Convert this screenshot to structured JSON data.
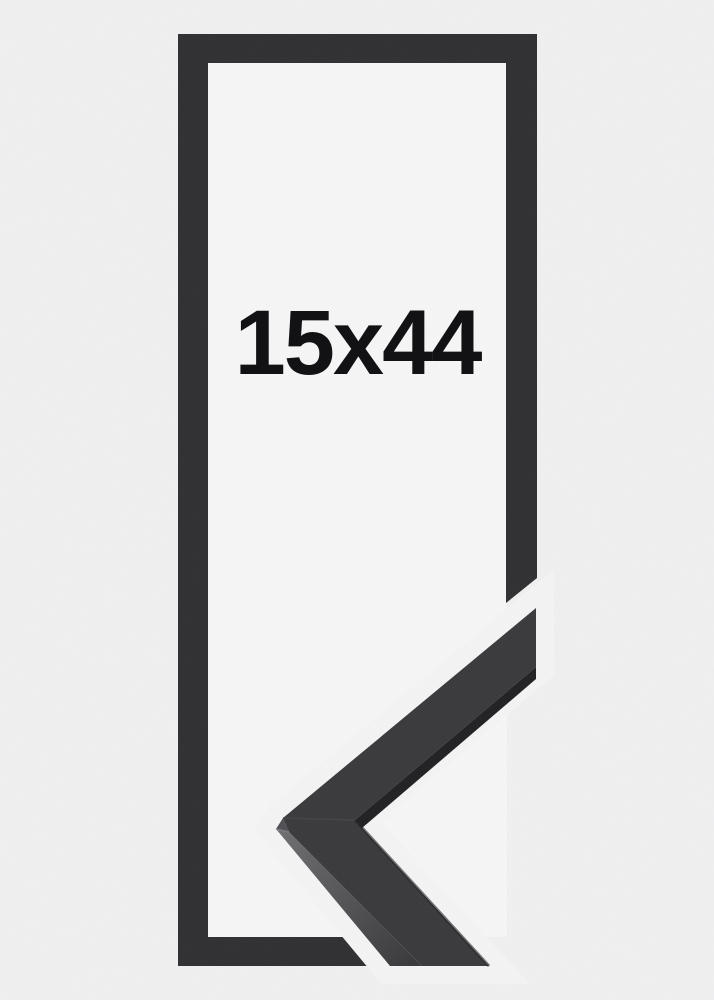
{
  "page": {
    "background_color": "#f0f0f1",
    "gap_color": "#f4f4f5"
  },
  "product_image": {
    "size_label": "15x44",
    "label_color": "#121214",
    "frame": {
      "front_color": "#2f2f31",
      "opening_color": "#f6f6f7"
    },
    "corner_sample": {
      "top_face_color": "#39393b",
      "inner_edge_color": "#202022",
      "side_face_light": "#6d6d71",
      "side_face_dark": "#38383a",
      "bevel_color": "#4f4f53",
      "seam_color": "#454548",
      "highlight_color": "#7d7d82"
    }
  }
}
